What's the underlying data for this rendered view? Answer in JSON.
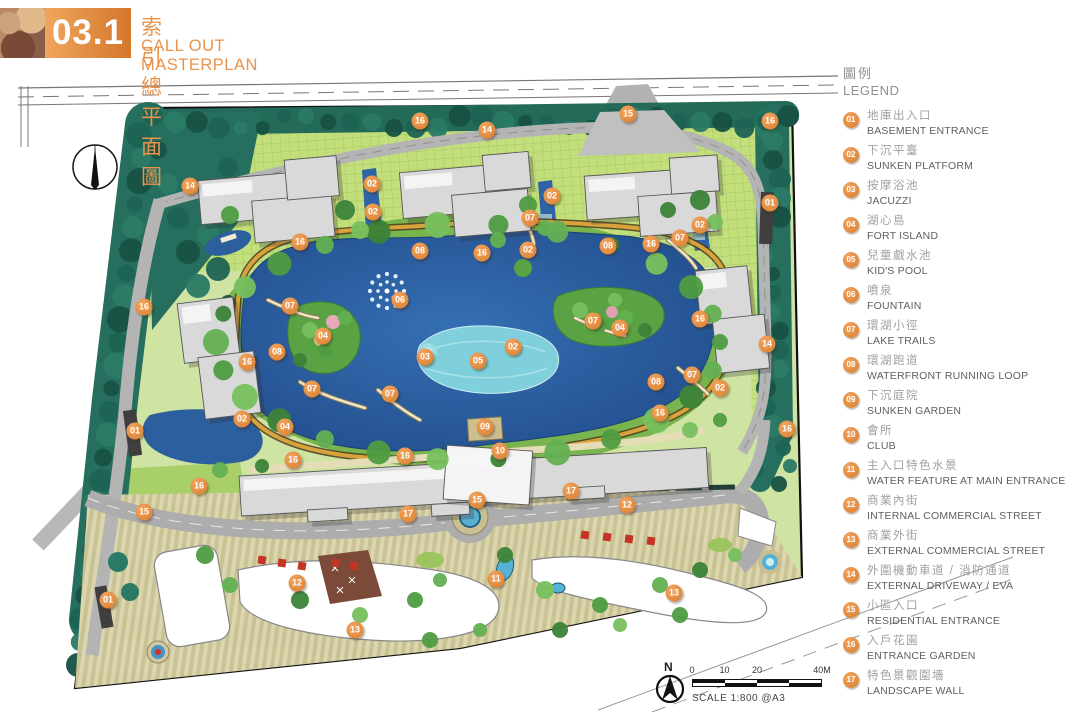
{
  "header": {
    "section_number": "03.1",
    "title_zh": "索引總平面圖",
    "title_en": "CALL OUT MASTERPLAN"
  },
  "legend": {
    "title_zh": "圖例",
    "title_en": "LEGEND",
    "items": [
      {
        "num": "01",
        "zh": "地庫出入口",
        "en": "BASEMENT ENTRANCE"
      },
      {
        "num": "02",
        "zh": "下沉平臺",
        "en": "SUNKEN PLATFORM"
      },
      {
        "num": "03",
        "zh": "按摩浴池",
        "en": "JACUZZI"
      },
      {
        "num": "04",
        "zh": "湖心島",
        "en": "FORT ISLAND"
      },
      {
        "num": "05",
        "zh": "兒童戲水池",
        "en": "KID'S POOL"
      },
      {
        "num": "06",
        "zh": "噴泉",
        "en": "FOUNTAIN"
      },
      {
        "num": "07",
        "zh": "環湖小徑",
        "en": "LAKE TRAILS"
      },
      {
        "num": "08",
        "zh": "環湖跑道",
        "en": "WATERFRONT RUNNING LOOP"
      },
      {
        "num": "09",
        "zh": "下沉庭院",
        "en": "SUNKEN GARDEN"
      },
      {
        "num": "10",
        "zh": "會所",
        "en": "CLUB"
      },
      {
        "num": "11",
        "zh": "主入口特色水景",
        "en": "WATER FEATURE AT MAIN ENTRANCE"
      },
      {
        "num": "12",
        "zh": "商業內街",
        "en": "INTERNAL COMMERCIAL STREET"
      },
      {
        "num": "13",
        "zh": "商業外街",
        "en": "EXTERNAL COMMERCIAL STREET"
      },
      {
        "num": "14",
        "zh": "外圍機動車道 / 消防通道",
        "en": "EXTERNAL DRIVEWAY / EVA"
      },
      {
        "num": "15",
        "zh": "小區入口",
        "en": "RESIDENTIAL ENTRANCE"
      },
      {
        "num": "16",
        "zh": "入戶花園",
        "en": "ENTRANCE GARDEN"
      },
      {
        "num": "17",
        "zh": "特色景觀圍墻",
        "en": "LANDSCAPE WALL"
      }
    ]
  },
  "scale": {
    "north_label": "N",
    "ticks": [
      "0",
      "10",
      "20",
      "40M"
    ],
    "text": "SCALE 1:800 @A3"
  },
  "markers": [
    {
      "n": "16",
      "x": 420,
      "y": 121
    },
    {
      "n": "14",
      "x": 487,
      "y": 130
    },
    {
      "n": "15",
      "x": 628,
      "y": 114
    },
    {
      "n": "16",
      "x": 770,
      "y": 121
    },
    {
      "n": "02",
      "x": 372,
      "y": 184
    },
    {
      "n": "14",
      "x": 190,
      "y": 186
    },
    {
      "n": "02",
      "x": 552,
      "y": 196
    },
    {
      "n": "01",
      "x": 770,
      "y": 203
    },
    {
      "n": "02",
      "x": 373,
      "y": 212
    },
    {
      "n": "07",
      "x": 530,
      "y": 218
    },
    {
      "n": "02",
      "x": 700,
      "y": 225
    },
    {
      "n": "07",
      "x": 680,
      "y": 238
    },
    {
      "n": "16",
      "x": 300,
      "y": 242
    },
    {
      "n": "16",
      "x": 651,
      "y": 244
    },
    {
      "n": "08",
      "x": 608,
      "y": 246
    },
    {
      "n": "02",
      "x": 528,
      "y": 250
    },
    {
      "n": "08",
      "x": 420,
      "y": 251
    },
    {
      "n": "16",
      "x": 482,
      "y": 253
    },
    {
      "n": "06",
      "x": 400,
      "y": 300
    },
    {
      "n": "07",
      "x": 290,
      "y": 306
    },
    {
      "n": "16",
      "x": 144,
      "y": 307
    },
    {
      "n": "16",
      "x": 700,
      "y": 319
    },
    {
      "n": "07",
      "x": 593,
      "y": 321
    },
    {
      "n": "04",
      "x": 620,
      "y": 328
    },
    {
      "n": "04",
      "x": 323,
      "y": 336
    },
    {
      "n": "14",
      "x": 767,
      "y": 344
    },
    {
      "n": "02",
      "x": 513,
      "y": 347
    },
    {
      "n": "08",
      "x": 277,
      "y": 352
    },
    {
      "n": "03",
      "x": 425,
      "y": 357
    },
    {
      "n": "05",
      "x": 478,
      "y": 361
    },
    {
      "n": "16",
      "x": 247,
      "y": 362
    },
    {
      "n": "07",
      "x": 692,
      "y": 375
    },
    {
      "n": "08",
      "x": 656,
      "y": 382
    },
    {
      "n": "02",
      "x": 720,
      "y": 388
    },
    {
      "n": "07",
      "x": 312,
      "y": 389
    },
    {
      "n": "07",
      "x": 390,
      "y": 394
    },
    {
      "n": "16",
      "x": 660,
      "y": 413
    },
    {
      "n": "02",
      "x": 242,
      "y": 419
    },
    {
      "n": "04",
      "x": 285,
      "y": 427
    },
    {
      "n": "09",
      "x": 485,
      "y": 427
    },
    {
      "n": "16",
      "x": 787,
      "y": 429
    },
    {
      "n": "01",
      "x": 135,
      "y": 431
    },
    {
      "n": "10",
      "x": 500,
      "y": 451
    },
    {
      "n": "16",
      "x": 405,
      "y": 456
    },
    {
      "n": "16",
      "x": 293,
      "y": 460
    },
    {
      "n": "16",
      "x": 199,
      "y": 486
    },
    {
      "n": "17",
      "x": 571,
      "y": 491
    },
    {
      "n": "15",
      "x": 477,
      "y": 500
    },
    {
      "n": "12",
      "x": 627,
      "y": 505
    },
    {
      "n": "15",
      "x": 144,
      "y": 512
    },
    {
      "n": "17",
      "x": 408,
      "y": 514
    },
    {
      "n": "11",
      "x": 496,
      "y": 579
    },
    {
      "n": "12",
      "x": 297,
      "y": 583
    },
    {
      "n": "13",
      "x": 674,
      "y": 593
    },
    {
      "n": "01",
      "x": 108,
      "y": 600
    },
    {
      "n": "13",
      "x": 355,
      "y": 630
    }
  ],
  "colors": {
    "accent_orange": "#E0883F",
    "lake_blue": "#2B5F9E",
    "teal_green": "#1D6354",
    "lawn_green": "#BCDC6E"
  }
}
